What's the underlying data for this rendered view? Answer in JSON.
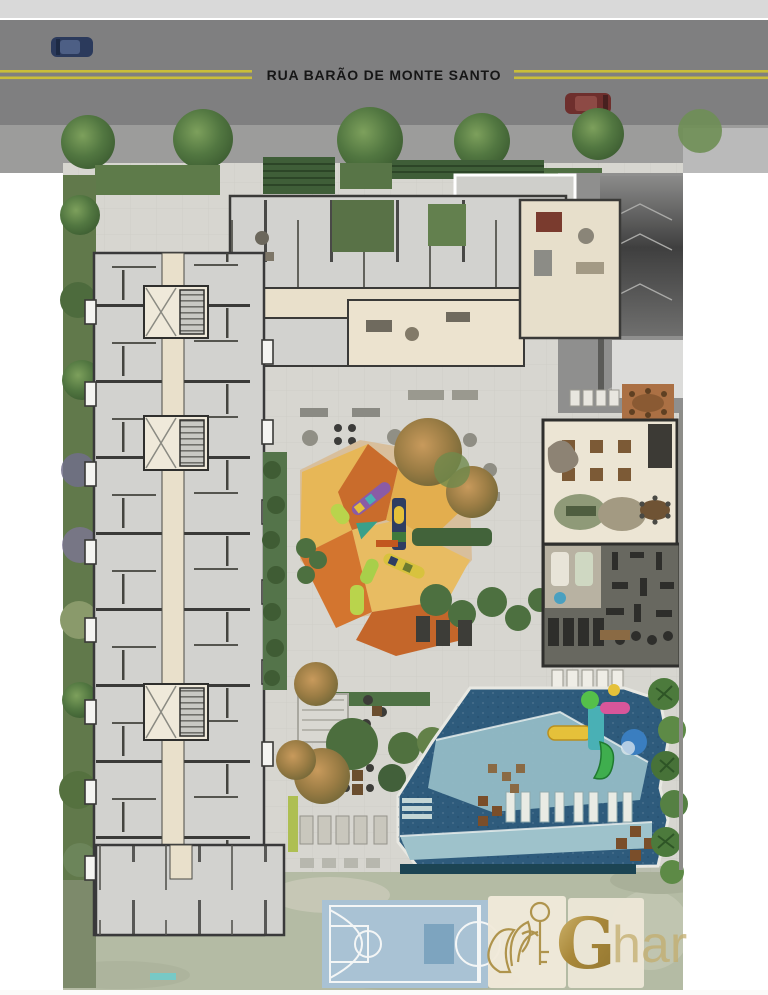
{
  "street": {
    "name": "RUA BARÃO DE MONTE SANTO"
  },
  "watermark": {
    "initial": "G",
    "rest": "har"
  },
  "icons": {
    "car-blue-icon": "rounded-rect-top-view-car",
    "car-red-icon": "rounded-rect-top-view-car",
    "tree-icon": "green-circle-cluster",
    "palm-icon": "starburst-green",
    "water-slide-icon": "colored-blocks-with-curved-slide",
    "playground-equipment-icon": "colored-blocks",
    "basketball-court-icon": "court-lines",
    "logo-plant-key-icon": "gold-line-art"
  },
  "colors": {
    "road": "#7f7f80",
    "sidewalkTop": "#d9d9d9",
    "sidewalkBand": "#9c9c9b",
    "lineYellow": "#c9bd3a",
    "paving": "#d7d6d0",
    "building": "#d2d2cf",
    "wall": "#39393a",
    "corridor": "#e9e0cb",
    "hedge": "#5f7c49",
    "tree": "#4d6f3e",
    "playgroundAmber": "#e7b757",
    "playgroundOrange": "#c96c2c",
    "playgroundTan": "#d8bf9c",
    "poolDeep": "#2e5b7c",
    "poolLight": "#93bcc6",
    "poolEdge": "#1c4453",
    "gymFloor": "#686860",
    "deckBrown": "#ab7044",
    "courtBlue": "#a9c2d4",
    "courtLine": "#f4f6f6",
    "panelCream": "#f0e9da",
    "gold": "#a98b3e",
    "goldLight": "#c3ad6e",
    "carBlue": "#2b3a5c",
    "carRed": "#6e2f2d",
    "ramp": "#565655",
    "lawn": "#b4bba4"
  }
}
